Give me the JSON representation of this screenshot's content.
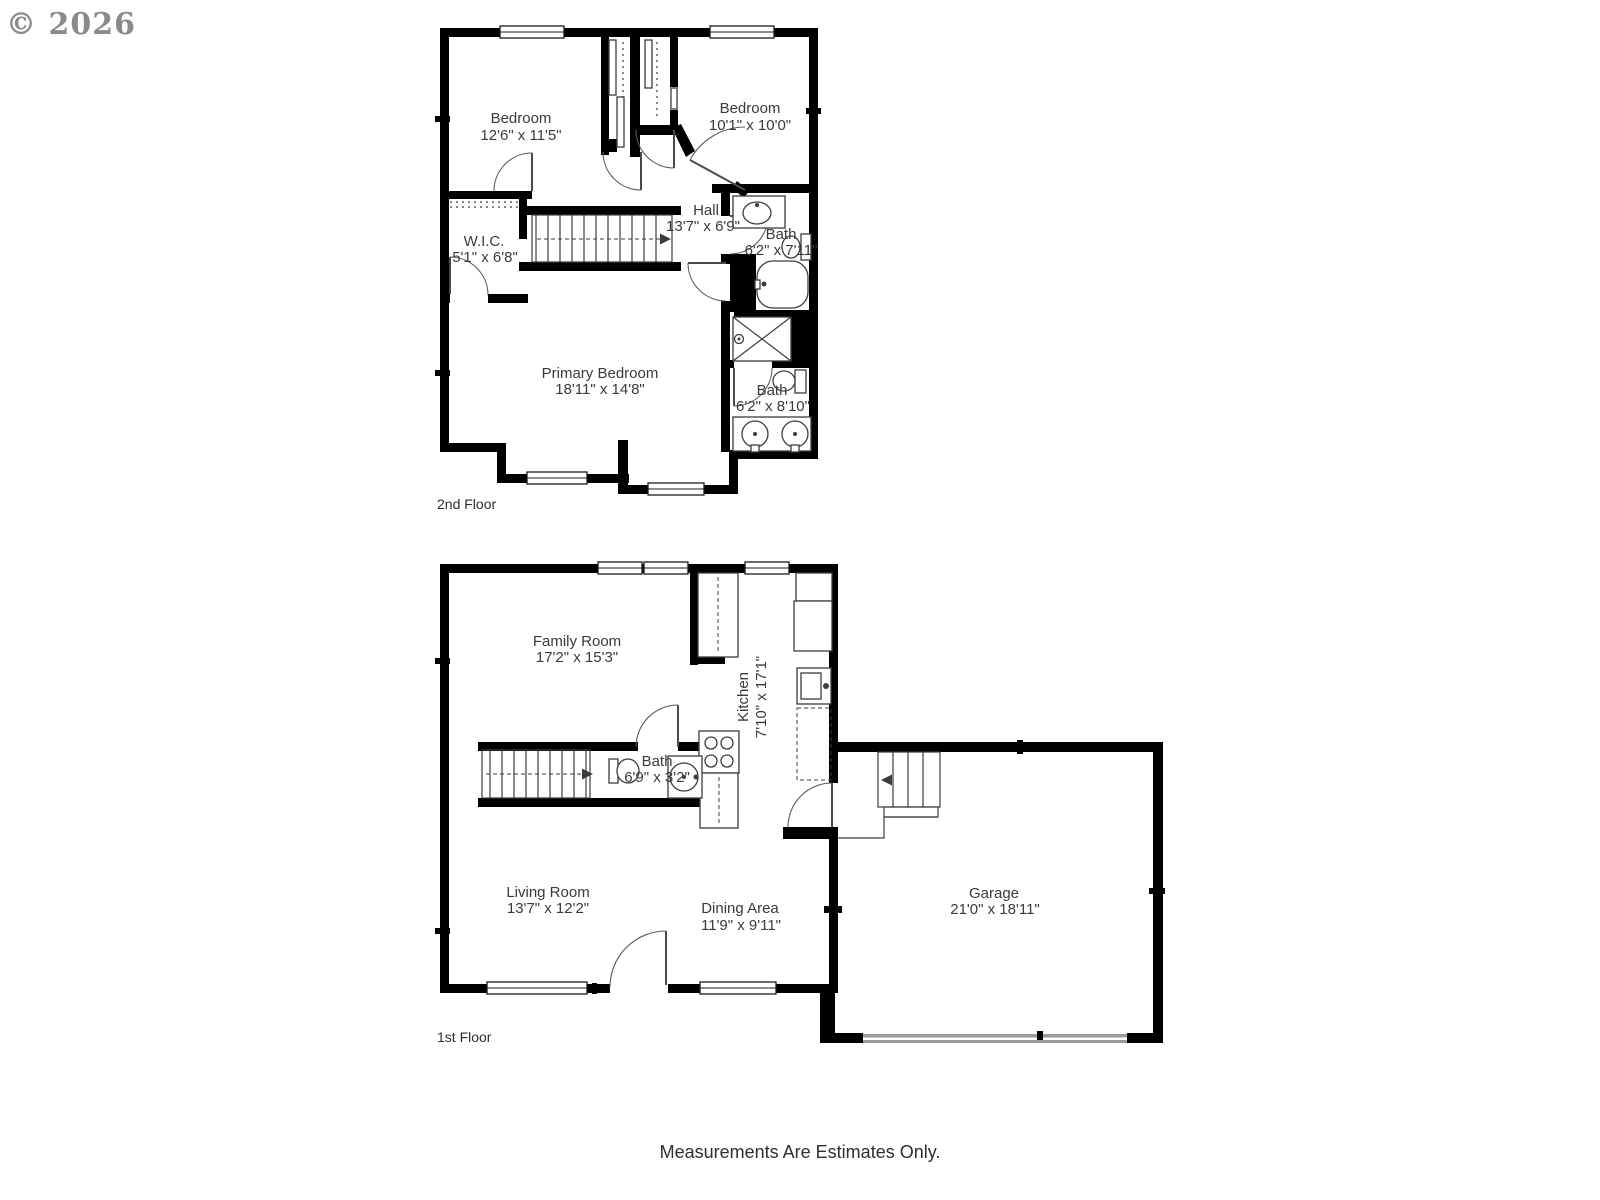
{
  "watermark": "© 2026",
  "footer": "Measurements Are Estimates Only.",
  "colors": {
    "wall": "#000000",
    "fixture": "#3c3c3c",
    "text": "#3a3a3a",
    "watermark": "#8a8a8a",
    "garage_door": "#9b9b9b"
  },
  "floors": [
    {
      "label": "2nd Floor",
      "rooms": [
        {
          "name": "Bedroom",
          "dims": "12'6\" x 11'5\""
        },
        {
          "name": "Bedroom",
          "dims": "10'1\" x 10'0\""
        },
        {
          "name": "Hall",
          "dims": "13'7\" x 6'9\""
        },
        {
          "name": "Bath",
          "dims": "6'2\" x 7'11\""
        },
        {
          "name": "W.I.C.",
          "dims": "5'1\" x 6'8\""
        },
        {
          "name": "Primary Bedroom",
          "dims": "18'11\" x 14'8\""
        },
        {
          "name": "Bath",
          "dims": "6'2\" x 8'10\""
        }
      ]
    },
    {
      "label": "1st Floor",
      "rooms": [
        {
          "name": "Family Room",
          "dims": "17'2\" x 15'3\""
        },
        {
          "name": "Kitchen",
          "dims": "7'10\" x 17'1\""
        },
        {
          "name": "Bath",
          "dims": "6'9\" x 3'2\""
        },
        {
          "name": "Living Room",
          "dims": "13'7\" x 12'2\""
        },
        {
          "name": "Dining Area",
          "dims": "11'9\" x 9'11\""
        },
        {
          "name": "Garage",
          "dims": "21'0\" x 18'11\""
        }
      ]
    }
  ]
}
